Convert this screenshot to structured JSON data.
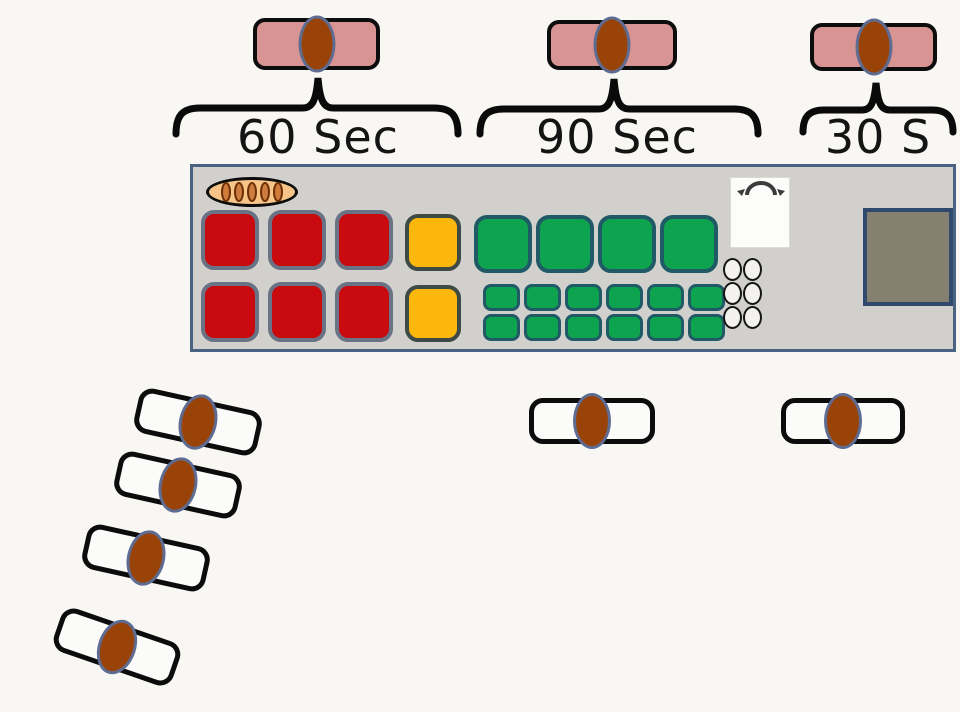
{
  "canvas": {
    "background": "#f8f7f4"
  },
  "colors": {
    "pink_station": "#d89492",
    "person_fill": "#9a4308",
    "person_outline": "#5e6c92",
    "station_bg": "#d2d0cc",
    "station_border": "#4a6382",
    "red_fill": "#c90b10",
    "red_border": "#6a7285",
    "yellow_fill": "#fcb70d",
    "yellow_border": "#3d4a45",
    "green_fill": "#0ea44f",
    "green_border": "#1f5a66",
    "dark_square_fill": "#868070",
    "dark_square_border": "#2f4a6c",
    "tray_fill": "#f8c488",
    "tray_item_fill": "#cf7b3e",
    "tray_item_border": "#6b3005",
    "egg_fill": "#f4f2ef",
    "white_station": "#fbfbfa",
    "brace_color": "#0a0a0a",
    "label_color": "#141414"
  },
  "timing_zones": [
    {
      "label": "60 Sec"
    },
    {
      "label": "90 Sec"
    },
    {
      "label": "30 S"
    }
  ],
  "grill": {
    "red_grid": {
      "rows": 2,
      "cols": 3
    },
    "yellow_stack": {
      "count": 2
    },
    "green_large_row": {
      "count": 4
    },
    "green_small_grid": {
      "rows": 2,
      "cols": 6
    },
    "egg_grid": {
      "rows": 3,
      "cols": 2
    },
    "tray": {
      "items": 5
    }
  },
  "people": {
    "top_stations": 3,
    "queue": 4,
    "floor_stations": 2
  }
}
